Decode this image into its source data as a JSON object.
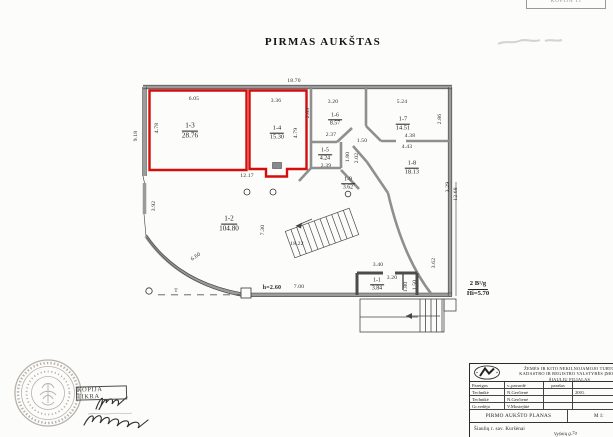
{
  "page": {
    "title": "PIRMAS AUKŠTAS"
  },
  "plan": {
    "rooms": [
      {
        "id": "1-1",
        "area": "3.84"
      },
      {
        "id": "1-2",
        "area": "104.80"
      },
      {
        "id": "1-3",
        "area": "28.76",
        "highlighted": true
      },
      {
        "id": "1-4",
        "area": "15.30",
        "highlighted": true
      },
      {
        "id": "1-5",
        "area": "4.24"
      },
      {
        "id": "1-6",
        "area": "8.57"
      },
      {
        "id": "1-7",
        "area": "14.51"
      },
      {
        "id": "1-8",
        "area": "18.13"
      },
      {
        "id": "1-9",
        "area": "3.62"
      }
    ],
    "highlight_color": "#d40d0d",
    "dims": {
      "overall_top": "18.70",
      "overall_left": "9.18",
      "r3_top": "6.05",
      "r3_left": "4.78",
      "r3_bottom": "12.17",
      "r4_top": "3.36",
      "r4_right": "4.79",
      "r6_left": "2.83",
      "r6_top": "3.20",
      "r6_bottom": "2.37",
      "chamfer": "1.50",
      "r5_bottom": "2.39",
      "r5_right": "1.80",
      "corridor": "2.02",
      "r7_top": "5.24",
      "r7_right": "2.86",
      "r7_bottom": "4.38",
      "r8_top": "4.43",
      "right_a": "3.29",
      "right_b": "12.68",
      "r2_left": "3.92",
      "r2_mid": "7.30",
      "stair_len": "18.22",
      "curve": "6.60",
      "bottom_h": "h=2.60",
      "bottom_w": "7.00",
      "r1_top": "3.40",
      "r1_inner": "3.20",
      "r1_a": "1.80",
      "r1_b": "1.50",
      "r1_right": "3.62",
      "t_mark": "T"
    },
    "note": {
      "line1": "2 B¹/g",
      "line2": "Hi=5.70"
    }
  },
  "stamps": {
    "kopija_tikra": "KOPIJA TIKRA",
    "kopija_top": "KOPIJA TI"
  },
  "titleblock": {
    "org_line1": "ŽEMĖS IR KITO NEKILNOJAMOJO TURTO",
    "org_line2": "KADASTRO IR REGISTRO VALSTYBĖS ĮMONĖ",
    "org_line3": "ŠIAULIŲ FILIALAS",
    "col_pareigos": "Pareigos",
    "col_pavarde": "v.,pavardė",
    "col_parasas": "parašas",
    "rows": [
      {
        "pareigos": "Technikė",
        "pavarde": "N.Gerčienė",
        "data": "2001."
      },
      {
        "pareigos": "Technikė",
        "pavarde": "N.Gerčienė",
        "data": ""
      },
      {
        "pareigos": "Gr.vedėja",
        "pavarde": "V.Mosiejūtė",
        "data": ""
      }
    ],
    "plan_name": "PIRMO AUKŠTO PLANAS",
    "scale": "M 1:",
    "address": "Šiaulių r. sav.  Kuršėnai",
    "address_hand": "Vyšnių g.7a"
  }
}
